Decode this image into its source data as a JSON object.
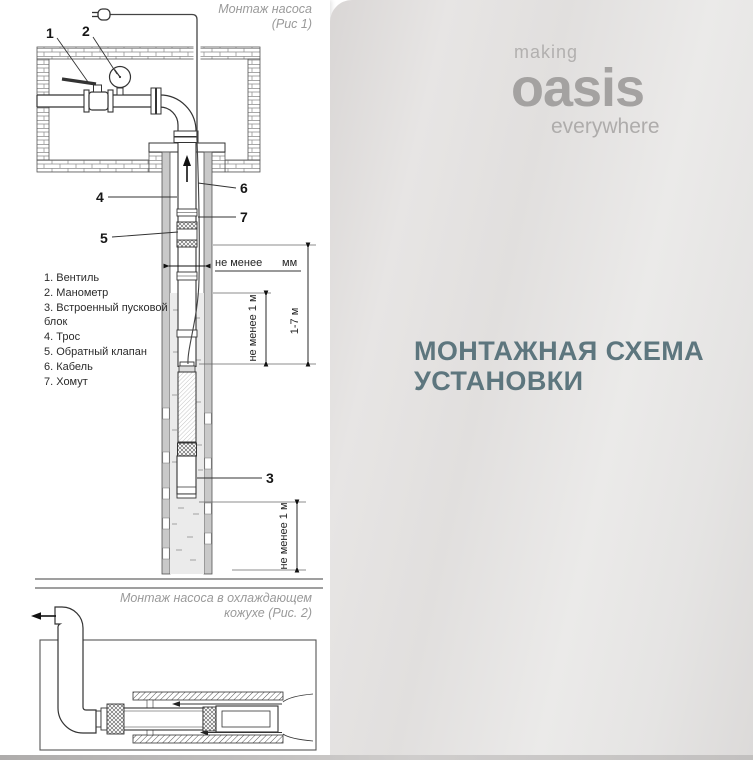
{
  "brand": {
    "making": "making",
    "oasis": "oasis",
    "everywhere": "everywhere"
  },
  "heading": {
    "line1": "МОНТАЖНАЯ СХЕМА",
    "line2": "УСТАНОВКИ"
  },
  "fig1": {
    "title_line1": "Монтаж насоса",
    "title_line2": "(Рис 1)",
    "legend": [
      "1. Вентиль",
      "2. Манометр",
      "3. Встроенный пусковой блок",
      "4. Трос",
      "5. Обратный клапан",
      "6. Кабель",
      "7. Хомут"
    ],
    "callouts": {
      "c1": "1",
      "c2": "2",
      "c3": "3",
      "c4": "4",
      "c5": "5",
      "c6": "6",
      "c7": "7"
    },
    "dims": {
      "min_width_label": "не менее",
      "min_width_unit": "мм",
      "submersion": "не менее 1 м",
      "depth_range": "1-7 м",
      "bottom_clearance": "не менее 1 м"
    }
  },
  "fig2": {
    "title_line1": "Монтаж насоса в охлаждающем",
    "title_line2": "кожухе (Рис. 2)"
  },
  "colors": {
    "heading": "#5d767e",
    "logo_gray": "#a6a4a3",
    "caption_gray": "#9a9a9a"
  }
}
